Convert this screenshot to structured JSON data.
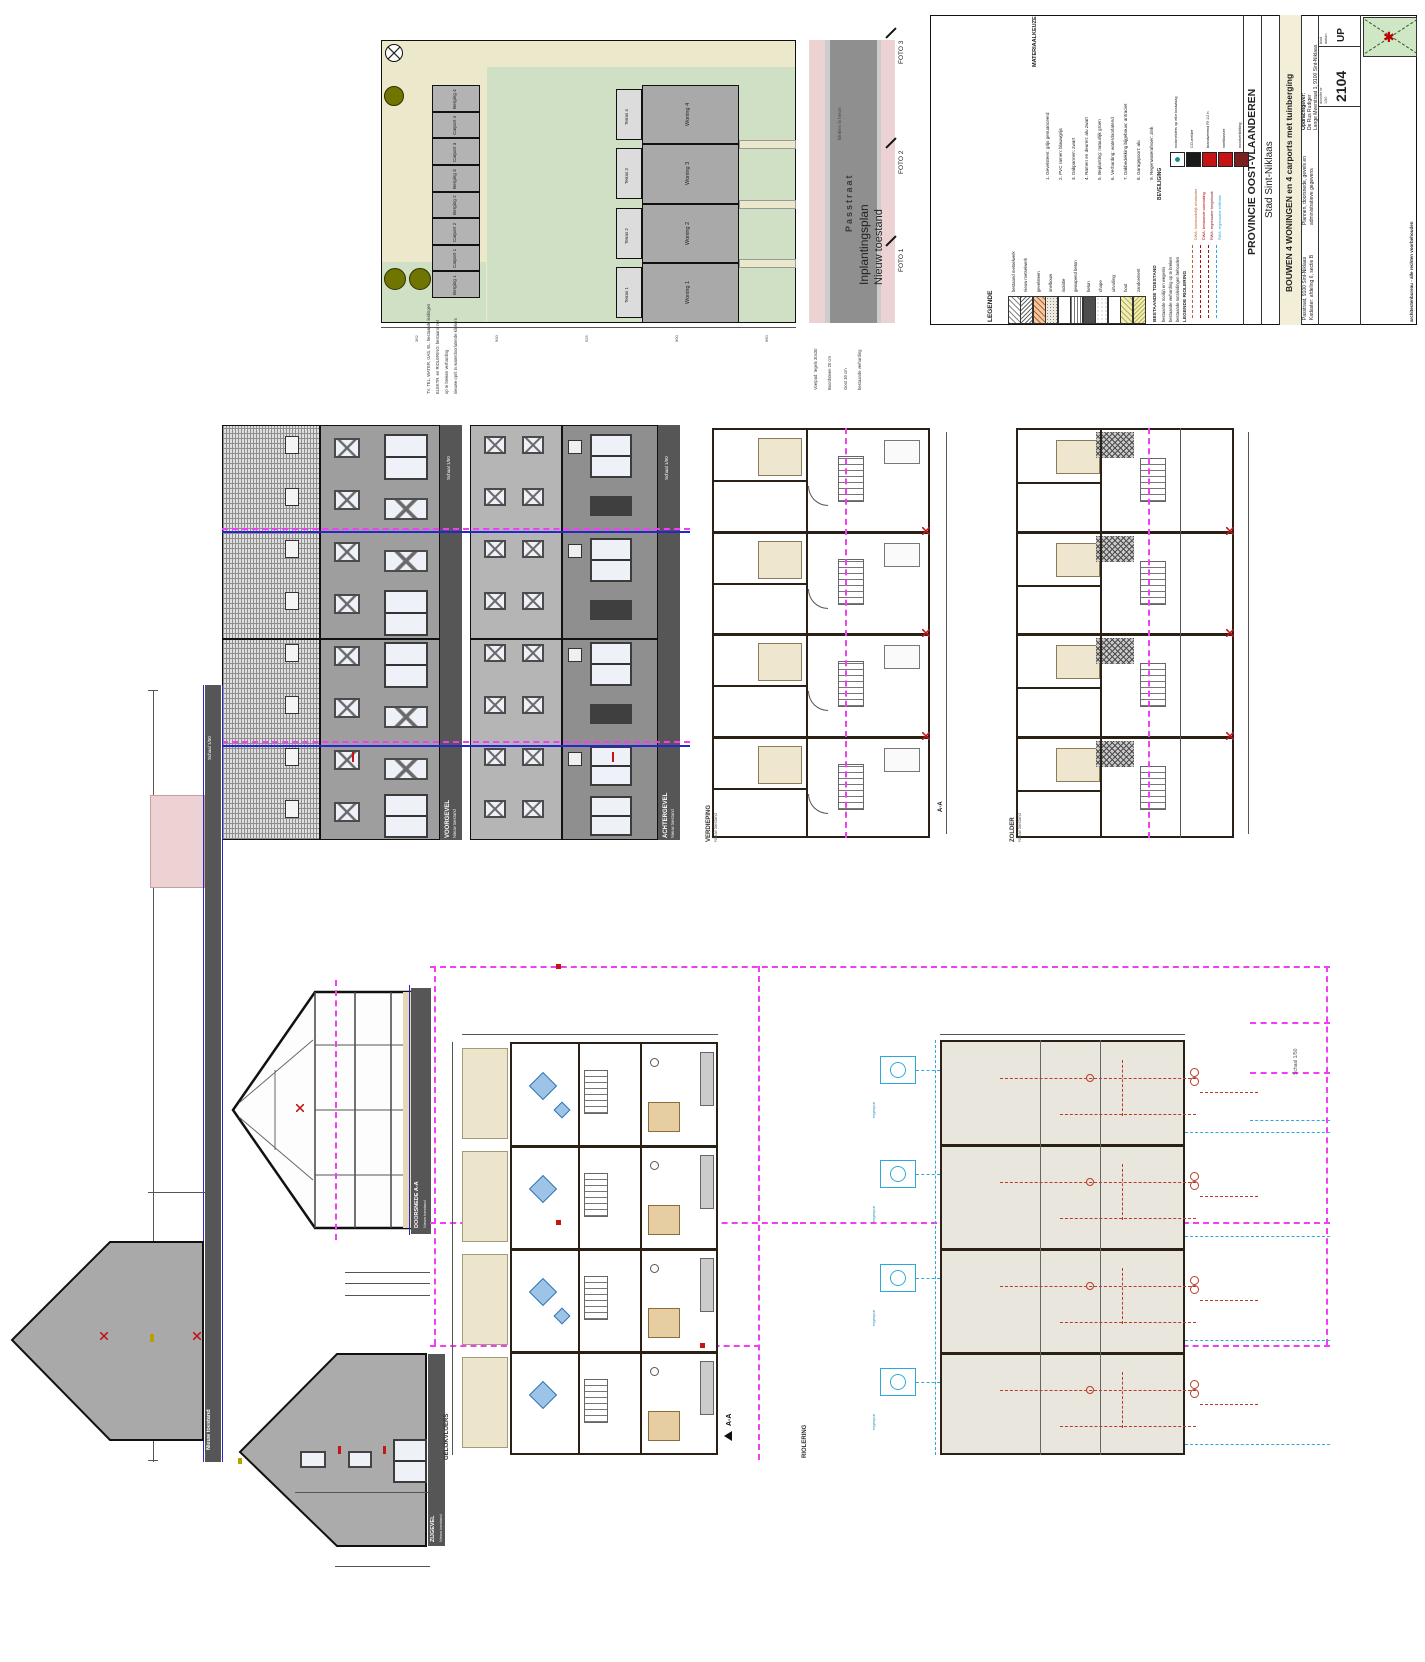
{
  "sheet": {
    "scale_note": "Schaal 1/50",
    "section_marker": "A-A",
    "new_state": "Nieuw toestand"
  },
  "colors": {
    "magenta": "#f23df2",
    "cyan": "#2ea8dc",
    "blue": "#2626c9",
    "red": "#c41414",
    "olive": "#6f7500",
    "beige": "#ece8cb",
    "green": "#cfe0c4",
    "road": "#8f8f8f",
    "pink": "#ecd2d2"
  },
  "site_plan": {
    "title_line1": "Inplantingsplan",
    "title_line2": "Nieuw toestand",
    "street_name": "Passtraat",
    "street_surface": "klinkers in beton",
    "photos": [
      "FOTO 1",
      "FOTO 2",
      "FOTO 3"
    ],
    "houses": [
      "Woning 1",
      "Woning 2",
      "Woning 3",
      "Woning 4"
    ],
    "terraces": [
      "Terras 1",
      "Terras 2",
      "Terras 3",
      "Terras 4"
    ],
    "outbuildings": [
      "Berging 4",
      "Carport 4",
      "Carport 3",
      "Berging 3",
      "Berging 2",
      "Carport 2",
      "Carport 1",
      "Berging 1"
    ],
    "dims": [
      "362",
      "900",
      "525",
      "900",
      "960"
    ],
    "left_notes": [
      "TV, TEL, WATER, GAS, EL: bestaande leidingen",
      "ELEKTR. en RIOLERING: bestaand net",
      "op te breken verharding",
      "nieuwe oprit in waterdoorlatende klinkers"
    ],
    "right_notes": [
      "Voetpad: tegels 30x30",
      "Boordsteen 20 cm",
      "Goot 30 cm",
      "bestaande verharding"
    ]
  },
  "title_block": {
    "legend_title": "LEGENDE",
    "legend_items": [
      "bestaand metselwerk",
      "nieuw metselwerk",
      "gevelsteen",
      "snelbouw",
      "isolatie",
      "gewapend beton",
      "beton",
      "chape",
      "uitvulling",
      "hout",
      "zandcement"
    ],
    "materials_title": "MATERIAALKEUZE",
    "materials": [
      "1. Gevelsteen: grijs genuanceerd",
      "2. PVC ramen: blauwgrijs",
      "3. Dakpannen: zwart",
      "4. Ramen en deuren: alu zwart",
      "5. Beplanting: natuurlijk groen",
      "6. Verharding: waterdoorlatend",
      "7. Dakbedekking bijgebouw: antraciet",
      "8. Garagepoort: alu",
      "9. Regenwaterafvoer: zink"
    ],
    "existing_title": "BESTAANDE TOESTAND",
    "existing_lines": [
      "bestaande rooilijn en wegenis",
      "bestaande verharding op te breken",
      "bestaande nutsleidingen behouden"
    ],
    "sewer_legend_title": "LEGENDE RIOLERING",
    "sewer_items": [
      {
        "label": "DWA: huishoudelijk afvalwater",
        "color": "#c4622d"
      },
      {
        "label": "DWA: bestaande aansluiting",
        "color": "#c00000"
      },
      {
        "label": "RWA: regenwater hergebruik",
        "color": "#8b1a1a"
      },
      {
        "label": "RWA: regenwater infiltratie",
        "color": "#2ea8dc"
      }
    ],
    "safety_title": "BEVEILIGING",
    "safety_items": [
      "rookmelders op elke bouwlaag",
      "CO-melder",
      "brandwerend Rf 1/2 h",
      "snelblusser",
      "noodverlichting"
    ],
    "province": "PROVINCIE OOST-VLAANDEREN",
    "city": "Stad Sint-Niklaas",
    "project_title": "BOUWEN 4 WONINGEN en 4 carports met tuinberging",
    "address_lines": [
      "Passtraat, 9100 Sint-Niklaas",
      "Kadaster: afdeling 6, sectie B"
    ],
    "plans_lines": [
      "Plannen, doorsnede, gevels en",
      "administratieve gegevens"
    ],
    "client_lines": [
      "Opdrachtgever:",
      "De Rus Rudiger",
      "Lange Meerstraat 1, 9100 Sint-Niklaas"
    ],
    "architect_line": "architectenbureau - alle rechten voorbehouden",
    "logo_star_char": "✱",
    "cells": {
      "scale_label": "schaal",
      "scale_value": "1/50",
      "date_label": "datum",
      "dossier_label": "dossier nr",
      "dossier_value": "2104",
      "sheet_label": "blad",
      "sheet_value": "UP"
    }
  },
  "drawings": {
    "front_elevation": {
      "title": "VOORGEVEL"
    },
    "rear_elevation": {
      "title": "ACHTERGEVEL"
    },
    "floor_plan": {
      "title": "VERDIEPING"
    },
    "attic_plan": {
      "title": "ZOLDER"
    },
    "section": {
      "title": "DOORSNEDE A-A"
    },
    "side_gable": {
      "title": "ZIJGEVEL"
    },
    "street_strip": {
      "title": "Nieuw toestand"
    },
    "ground_plan": {
      "title": "GELIJKVLOERS"
    },
    "sewer_plan": {
      "title": "RIOLERING",
      "rwa": "RWA",
      "dwa": "DWA",
      "note": "regenput"
    }
  }
}
